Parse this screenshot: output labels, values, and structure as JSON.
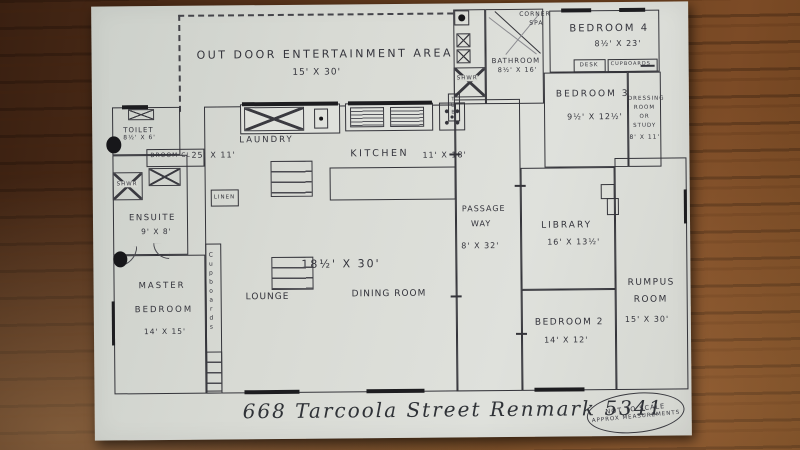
{
  "plan": {
    "address": "668 Tarcoola Street Renmark 5341",
    "note": {
      "line1": "NOT TO SCALE",
      "line2": "APPROX MEASUREMENTS"
    },
    "rooms": {
      "outdoor": {
        "name": "Out Door Entertainment Area",
        "dims": "15' x 30'"
      },
      "corner_spa": {
        "line1": "Corner",
        "line2": "Spa"
      },
      "bathroom": {
        "name": "Bathroom",
        "dims": "8½' x 16'"
      },
      "bedroom4": {
        "name": "Bedroom 4",
        "dims": "8½' x 23'"
      },
      "bedroom3": {
        "name": "Bedroom 3",
        "dims": "9½' x 12½'"
      },
      "dressing": {
        "line1": "Dressing",
        "line2": "Room",
        "line3": "or",
        "line4": "Study",
        "dims": "8' x 11'"
      },
      "toilet": {
        "name": "Toilet",
        "dims": "8½' x 6'"
      },
      "broom": {
        "name": "Broom CL"
      },
      "shower_left": {
        "name": "SHWR"
      },
      "shower_top": {
        "name": "SHWR"
      },
      "tub": {
        "name": "TUB"
      },
      "ensuite": {
        "name": "Ensuite",
        "dims": "9' x 8'"
      },
      "master": {
        "line1": "Master",
        "line2": "Bedroom",
        "dims": "14' x 15'"
      },
      "laundry": {
        "name": "Laundry",
        "area_dims": "25' x 11'"
      },
      "linen": {
        "name": "Linen"
      },
      "kitchen": {
        "name": "Kitchen",
        "dims": "11' x 18'"
      },
      "lounge_dining": {
        "dims": "18½' x 30'",
        "lounge": "Lounge",
        "dining": "Dining Room"
      },
      "passage": {
        "line1": "Passage",
        "line2": "Way",
        "dims": "8' x 32'"
      },
      "library": {
        "name": "Library",
        "dims": "16' x 13½'"
      },
      "bedroom2": {
        "name": "Bedroom 2",
        "dims": "14' x 12'"
      },
      "rumpus": {
        "line1": "Rumpus",
        "line2": "Room",
        "dims": "15' x 30'"
      }
    },
    "fixtures": {
      "desk": "Desk",
      "cupboards": "Cupboards",
      "master_cupboards": "Cupboards"
    }
  }
}
